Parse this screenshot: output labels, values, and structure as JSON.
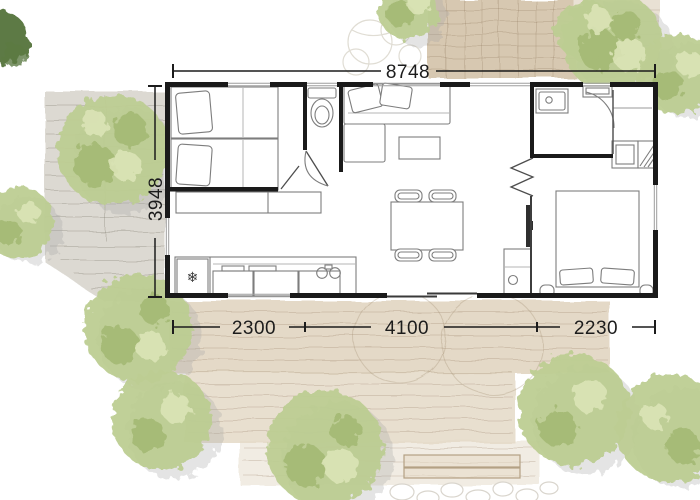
{
  "plan": {
    "dimensions": {
      "width_total": "8748",
      "depth_total": "3948",
      "bottom_segments": [
        "2300",
        "4100",
        "2230"
      ]
    },
    "icons": {
      "fridge_snowflake": "❄"
    }
  },
  "palette": {
    "wall": "#1a1a1a",
    "furn": "#7d7d7d",
    "dim": "#1c1c1c",
    "terrace": "#e4d9c7",
    "deck": "#d7c8b1",
    "pavement": "#dcd9d2",
    "tree_base": "#bdcd92",
    "tree_dark": "#9fb46d",
    "tree_light": "#dae3b6",
    "tree_shadow": "#a6a6a6",
    "dark_corner": "#5d7a44"
  }
}
